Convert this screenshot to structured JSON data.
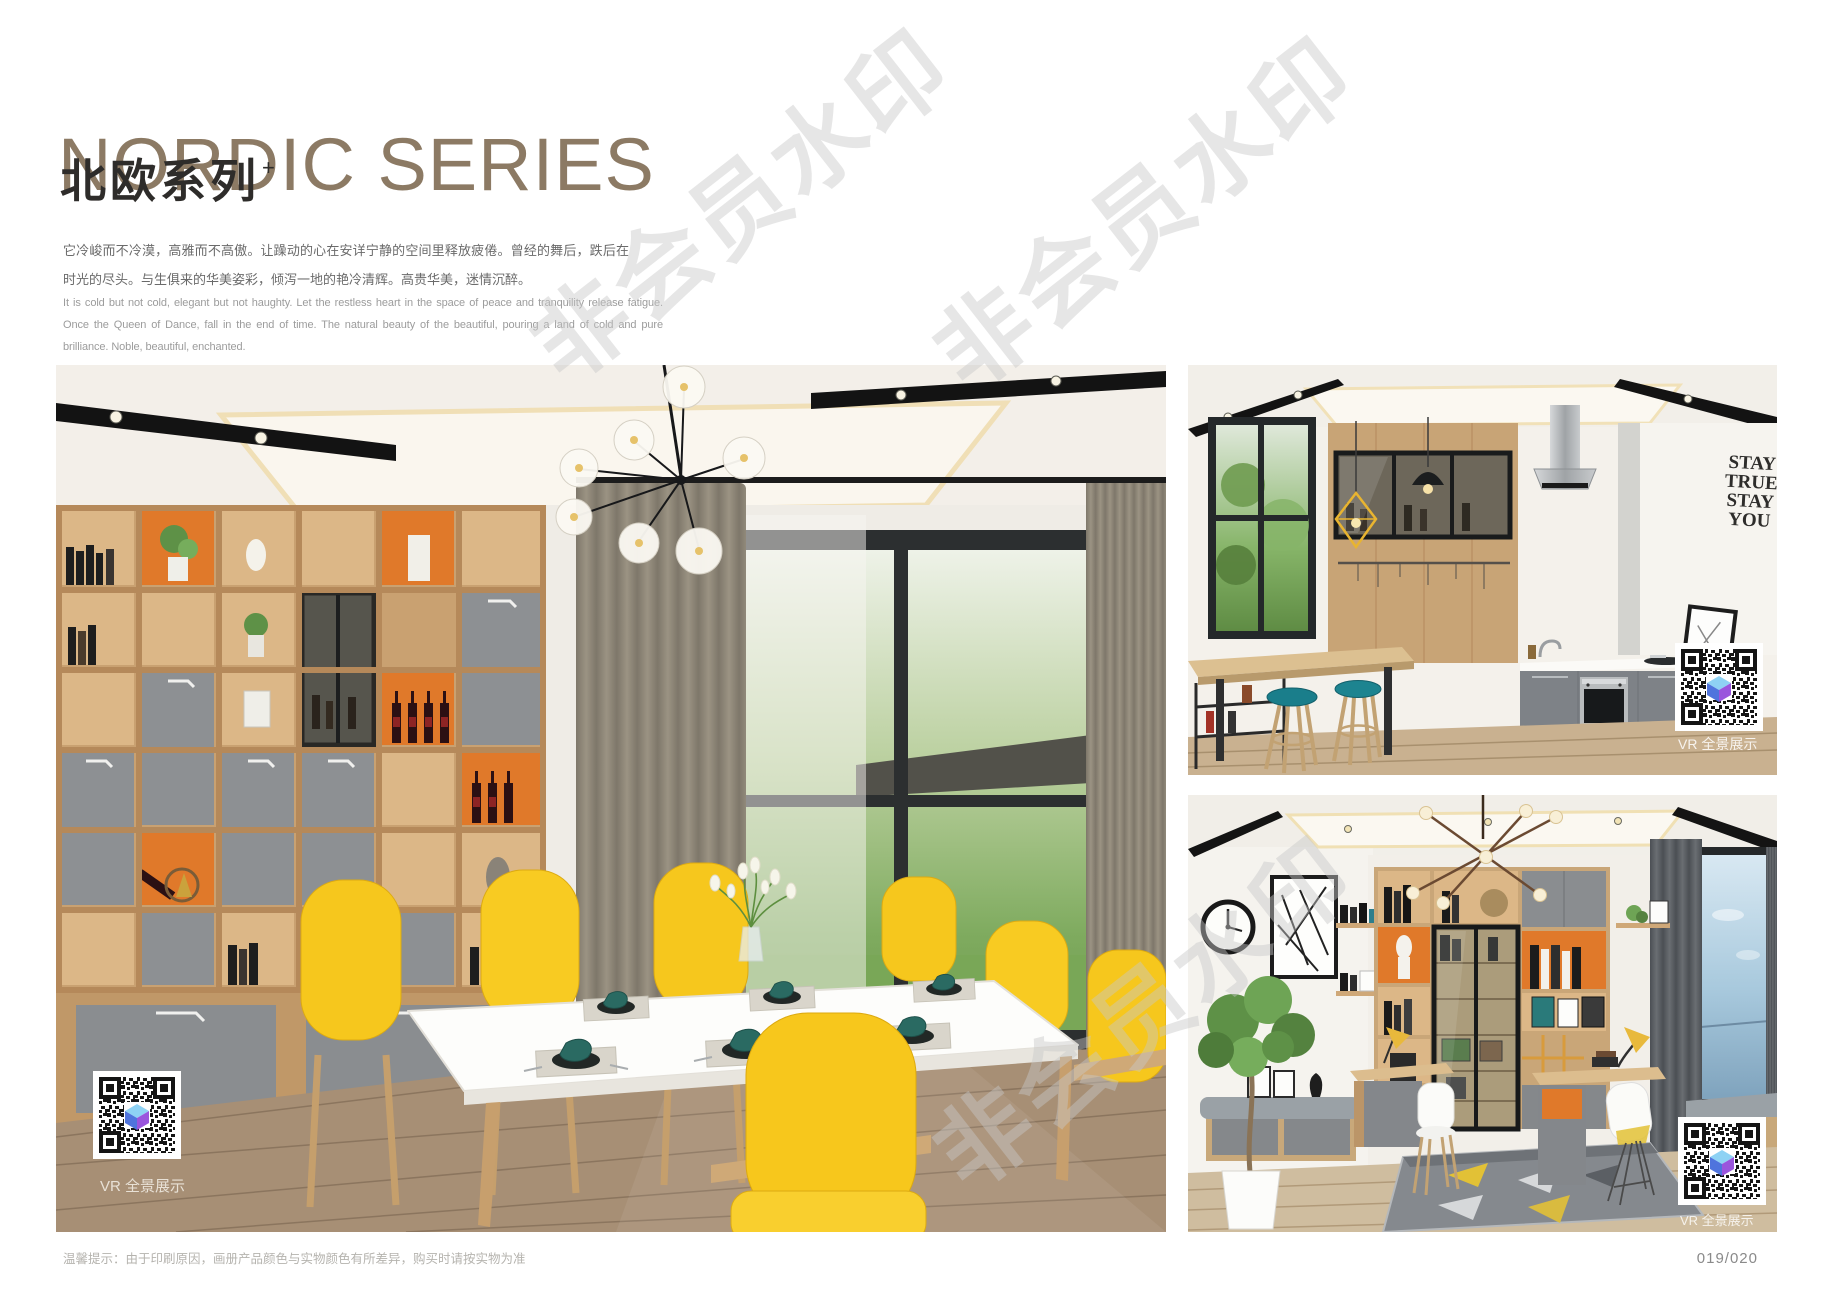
{
  "header": {
    "title_en": "NORDIC SERIES",
    "title_cn": "北欧系列",
    "title_superscript": "+",
    "intro_cn": "它冷峻而不冷漠，高雅而不高傲。让躁动的心在安详宁静的空间里释放疲倦。曾经的舞后，跌后在时光的尽头。与生俱来的华美姿彩，倾泻一地的艳冷清辉。高贵华美，迷情沉醉。",
    "intro_en": "It is cold but not cold, elegant but not haughty. Let the restless heart in the space of peace and tranquility release fatigue. Once the Queen of Dance, fall in the end of time. The natural beauty of the beautiful, pouring a land of cold and pure brilliance. Noble, beautiful, enchanted."
  },
  "watermark": {
    "text": "非会员水印"
  },
  "photos": {
    "dining": {
      "vr_label": "VR 全景展示"
    },
    "kitchen": {
      "vr_label": "VR 全景展示",
      "wall_sign": [
        "STAY",
        "TRUE",
        "STAY",
        "YOU"
      ]
    },
    "study": {
      "vr_label": "VR 全景展示"
    }
  },
  "footer": {
    "tip": "温馨提示：由于印刷原因，画册产品颜色与实物颜色有所差异，购买时请按实物为准",
    "page_number": "019/020"
  },
  "colors": {
    "title": "#8c7a64",
    "accent_orange": "#e0792a",
    "chair_yellow": "#f6c71d",
    "stool_teal": "#1a7e8b",
    "cabinet_gray": "#8a8d90",
    "wood": "#c9a678"
  }
}
